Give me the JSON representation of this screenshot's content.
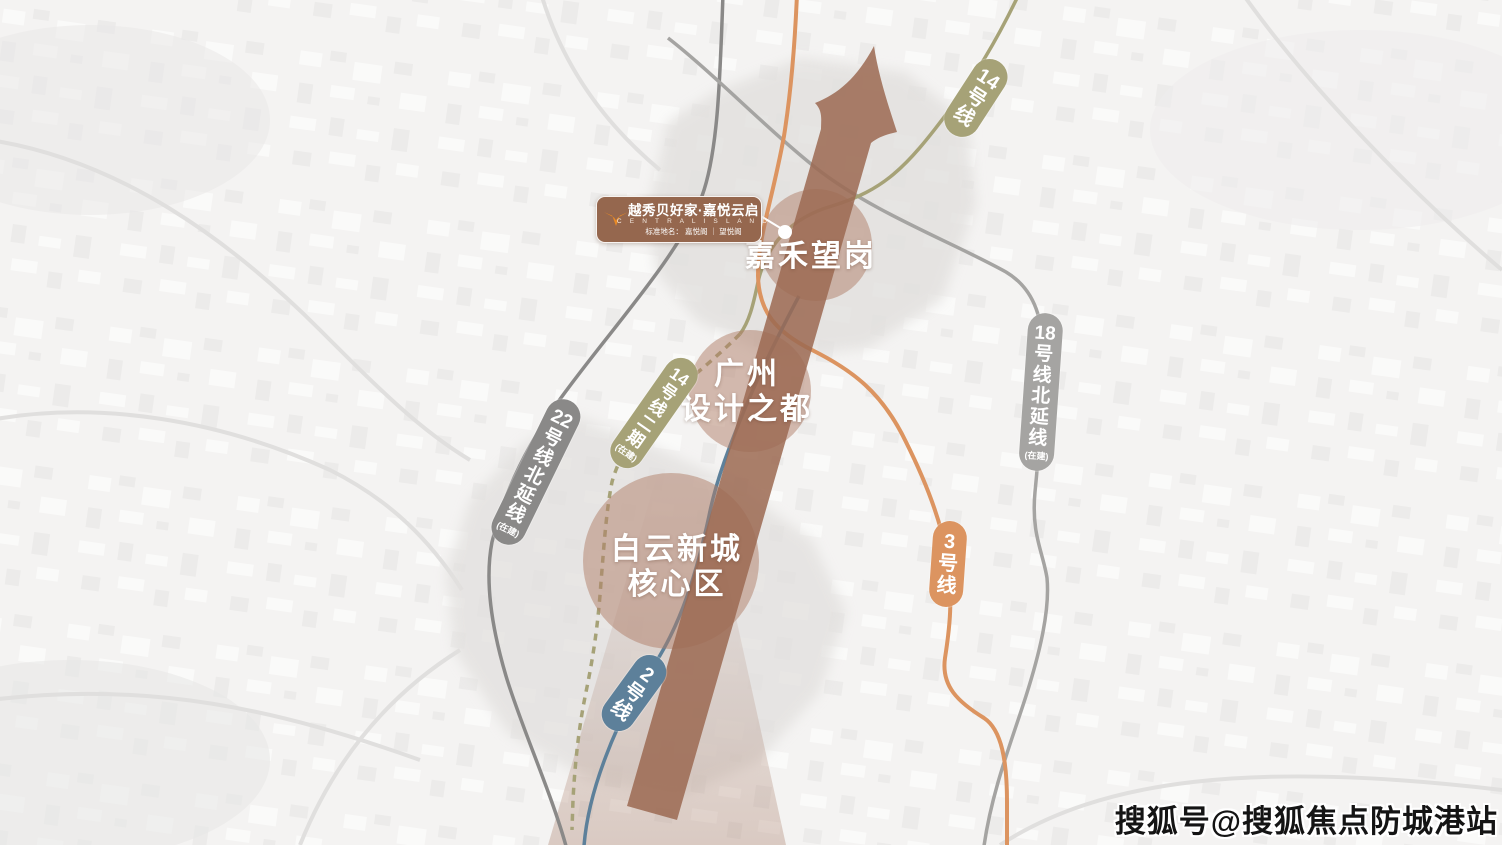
{
  "palette": {
    "axis_arrow": "#9c6a53",
    "zone_circle": "#af7e67",
    "district_fill": "#e2e0de",
    "cone_color": "#9c6a53",
    "logo_bg": "#95674e",
    "logo_icon": "#e98a25",
    "map_bg": "#f4f3f2",
    "connector": "#ffffff"
  },
  "logo": {
    "brand_line": "越秀贝好家·嘉悦云启",
    "english_line": "C E N T R A L   I S L A N D",
    "subtitle_line": "标准地名： 嘉悦阁 ｜ 望悦阁"
  },
  "zones": [
    {
      "name": "嘉禾望岗",
      "lines": [
        "嘉禾望岗"
      ]
    },
    {
      "name": "广州设计之都",
      "lines": [
        "广州",
        "设计之都"
      ]
    },
    {
      "name": "白云新城核心区",
      "lines": [
        "白云新城",
        "核心区"
      ]
    }
  ],
  "metro_lines": [
    {
      "id": "line-14",
      "label": "14号线",
      "status": "",
      "color": "#a6a277"
    },
    {
      "id": "line-14-phase-2",
      "label": "14号线二期",
      "status": "(在建)",
      "color": "#a6a277"
    },
    {
      "id": "line-18-north-extension",
      "label": "18号线北延线",
      "status": "(在建)",
      "color": "#a5a4a2"
    },
    {
      "id": "line-22-north-extension",
      "label": "22号线北延线",
      "status": "(在建)",
      "color": "#8a8988"
    },
    {
      "id": "line-3",
      "label": "3号线",
      "status": "",
      "color": "#dc9460"
    },
    {
      "id": "line-2",
      "label": "2号线",
      "status": "",
      "color": "#5d809a"
    }
  ],
  "watermark": "搜狐号@搜狐焦点防城港站"
}
